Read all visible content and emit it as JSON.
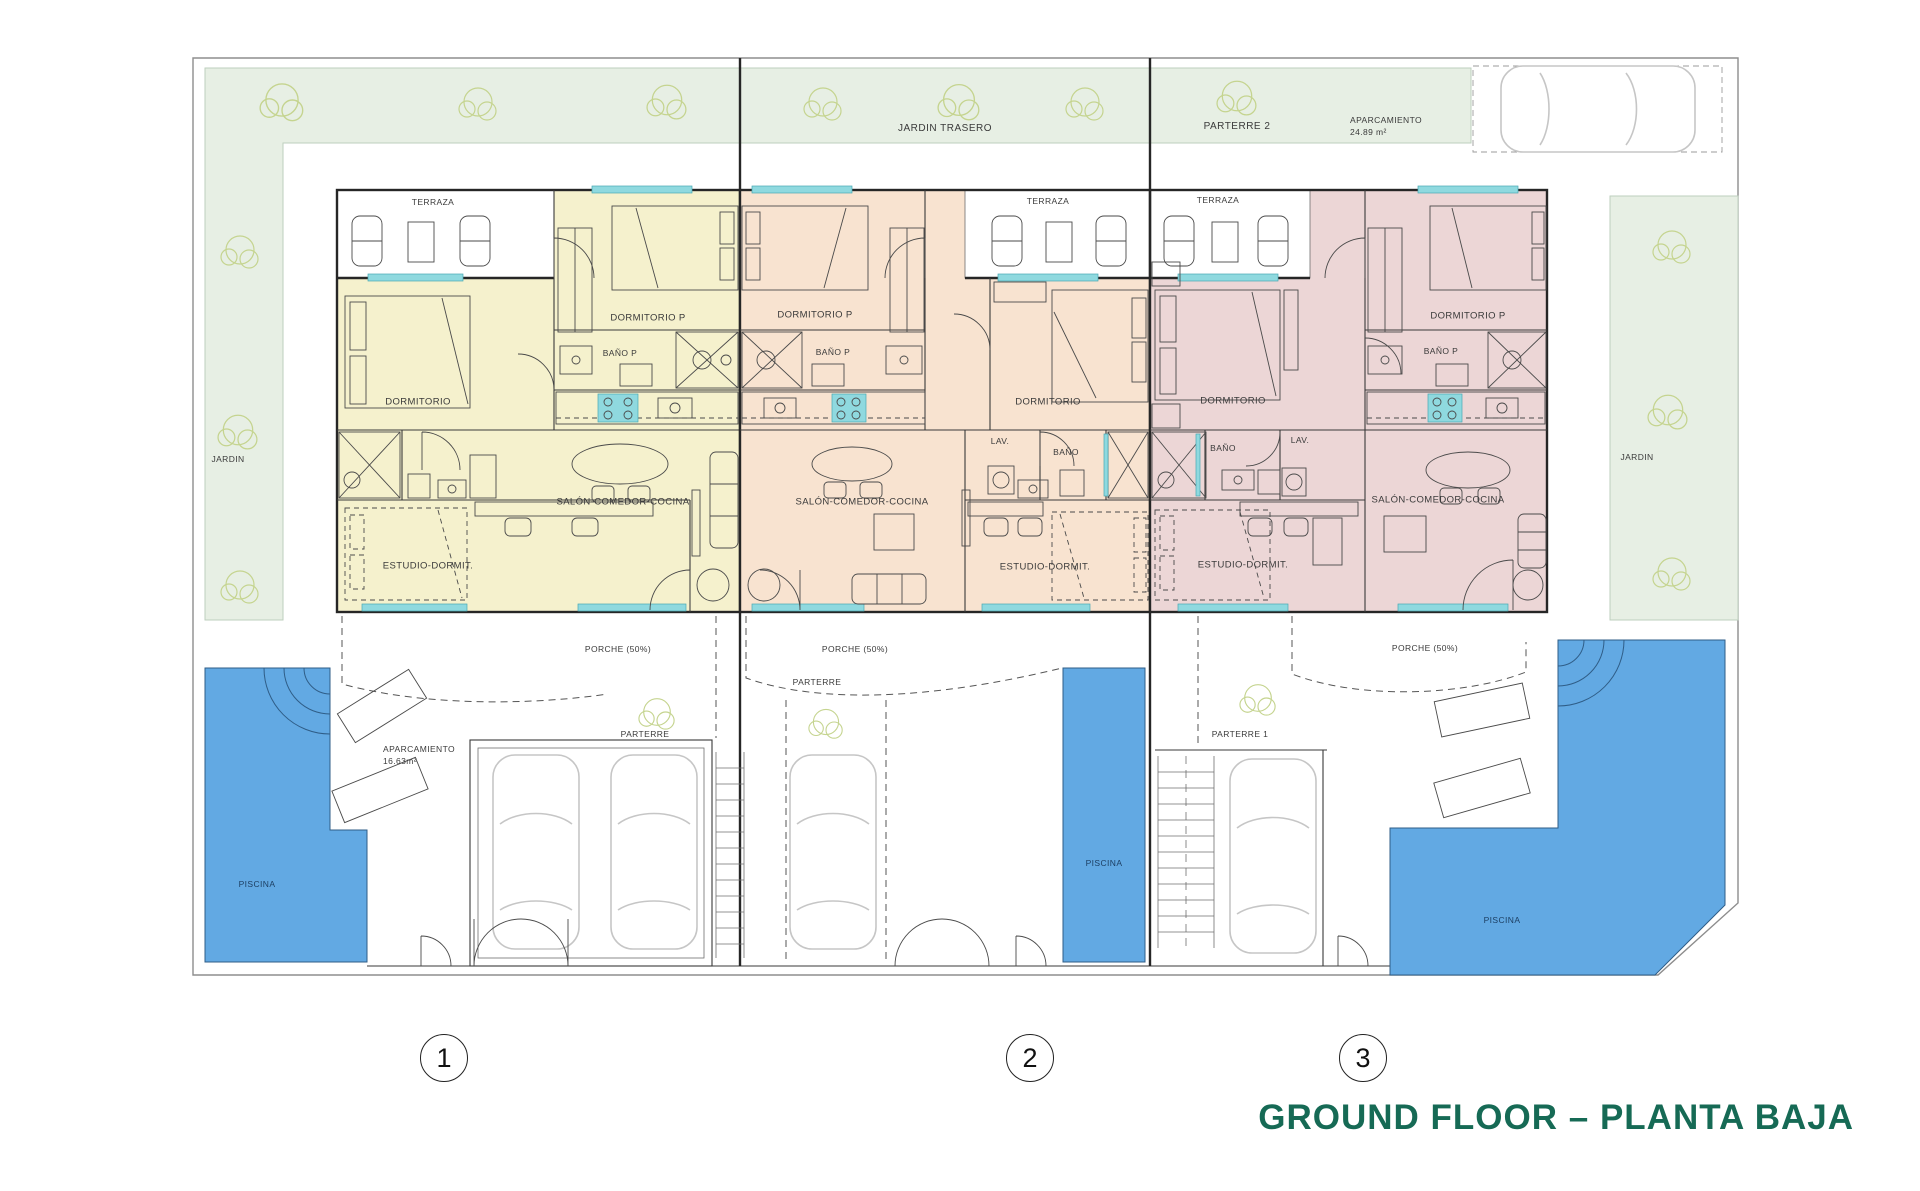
{
  "title": {
    "text": "GROUND FLOOR – PLANTA BAJA"
  },
  "garden": {
    "jardin_trasero": "JARDIN TRASERO",
    "parterre_2": "PARTERRE 2",
    "jardin_left": "JARDIN",
    "jardin_right": "JARDIN",
    "aparcamiento_top": {
      "label": "APARCAMIENTO",
      "area": "24.89 m²"
    },
    "aparcamiento_front": {
      "label": "APARCAMIENTO",
      "area": "16.63m²"
    }
  },
  "front": {
    "parterre_unit1": "PARTERRE",
    "parterre_unit2": "PARTERRE",
    "parterre_1": "PARTERRE 1",
    "piscina_1": "PISCINA",
    "piscina_2": "PISCINA",
    "piscina_3": "PISCINA"
  },
  "units": [
    {
      "number": "1",
      "terraza": "TERRAZA",
      "porche": "PORCHE (50%)",
      "rooms": {
        "dormitorio": "DORMITORIO",
        "dormitorio_p": "DORMITORIO P",
        "bano_p": "BAÑO P",
        "salon": "SALÓN-COMEDOR-COCINA",
        "estudio": "ESTUDIO-DORMIT."
      }
    },
    {
      "number": "2",
      "terraza": "TERRAZA",
      "porche": "PORCHE (50%)",
      "rooms": {
        "dormitorio": "DORMITORIO",
        "dormitorio_p": "DORMITORIO P",
        "bano_p": "BAÑO P",
        "bano": "BAÑO",
        "lav": "LAV.",
        "salon": "SALÓN-COMEDOR-COCINA",
        "estudio": "ESTUDIO-DORMIT."
      }
    },
    {
      "number": "3",
      "terraza": "TERRAZA",
      "porche": "PORCHE (50%)",
      "rooms": {
        "dormitorio": "DORMITORIO",
        "dormitorio_p": "DORMITORIO P",
        "bano_p": "BAÑO P",
        "bano": "BAÑO",
        "lav": "LAV.",
        "salon": "SALÓN-COMEDOR-COCINA",
        "estudio": "ESTUDIO-DORMIT."
      }
    }
  ],
  "colors": {
    "unit1-fill": "#f5f1cd",
    "unit2-fill": "#f8e3d0",
    "unit3-fill": "#ecd6d6",
    "garden-green": "#e7efe4",
    "pool-blue": "#62a9e3",
    "window-cyan": "#8fd9df",
    "tree-line": "#c5d48f",
    "car-gray": "#c6c6c6",
    "wall-dark": "#262626",
    "title-green": "#166a55"
  }
}
